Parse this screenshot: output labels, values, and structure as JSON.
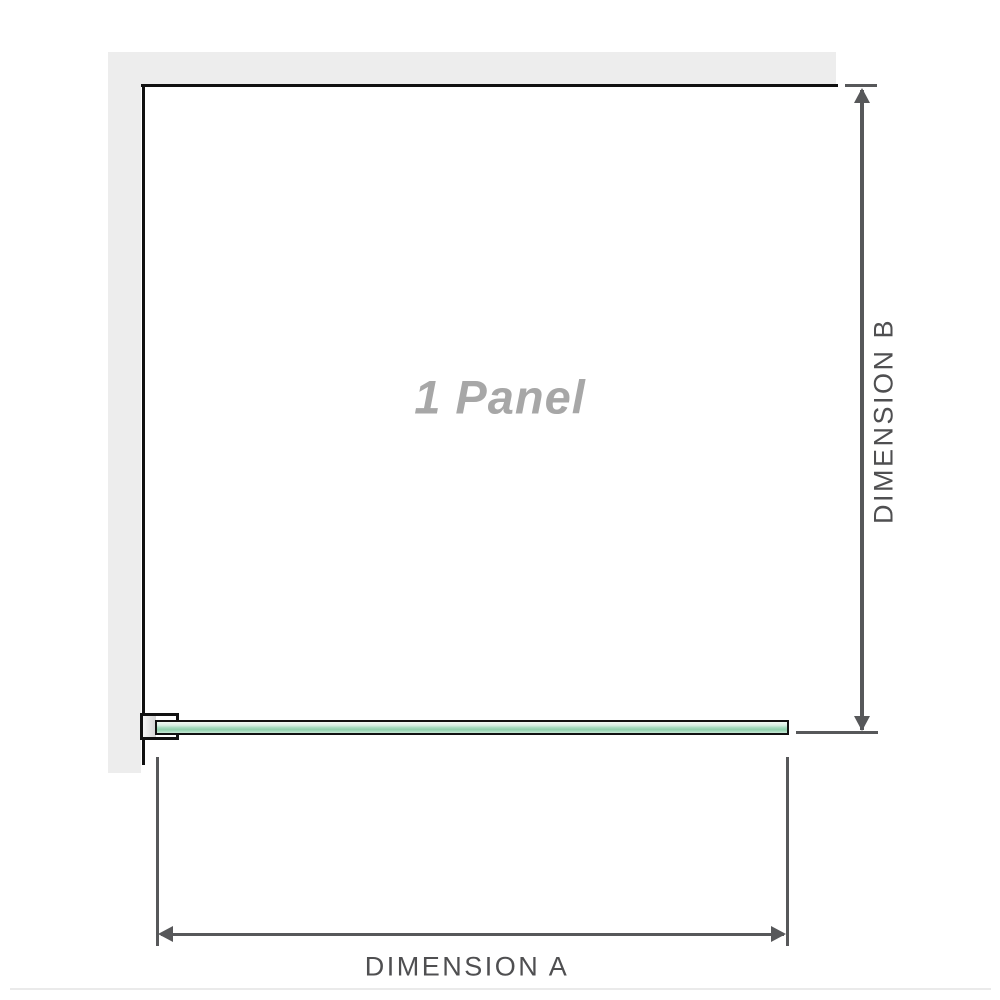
{
  "labels": {
    "panel": "1 Panel",
    "dimension_a": "DIMENSION A",
    "dimension_b": "DIMENSION B"
  },
  "icons": {
    "arrow_up": "dimension-arrowhead-up",
    "arrow_down": "dimension-arrowhead-down",
    "arrow_left": "dimension-arrowhead-left",
    "arrow_right": "dimension-arrowhead-right"
  },
  "colors": {
    "wall": "#ededed",
    "outline": "#111111",
    "dim-line": "#57585a",
    "dim-text": "#4f4f51",
    "panel-text": "#a7a7a7",
    "glass-1": "#f1f9f4",
    "glass-2": "#d7eee1",
    "glass-3": "#a4dabe",
    "glass-4": "#8fd0ac",
    "glass-5": "#c6e8d5",
    "bracket-light": "#f6f6f6",
    "bracket-dark": "#d4d4d4",
    "divider": "#eaeaea"
  }
}
